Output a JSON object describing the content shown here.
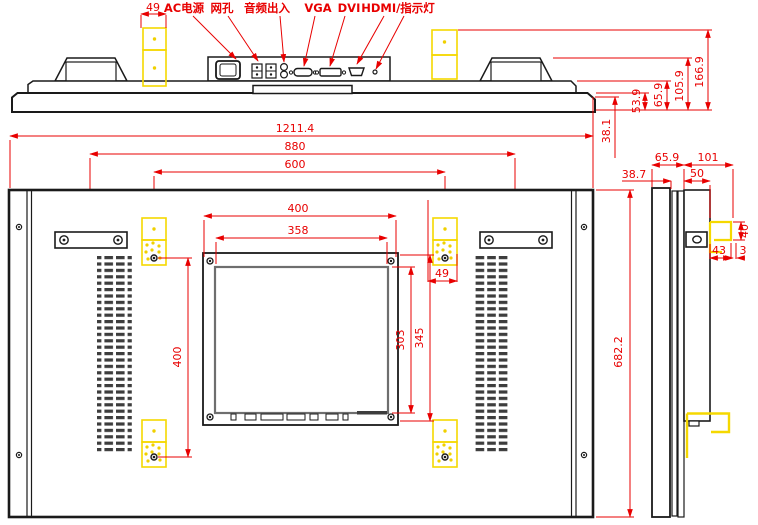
{
  "labels": {
    "ac_power": "AC电源",
    "mesh": "网孔",
    "audio": "音频出入",
    "vga": "VGA",
    "dvi": "DVI",
    "hdmi_led": "HDMI/指示灯"
  },
  "top_dims": {
    "bracket_w": "49",
    "depth_bezel": "53.9",
    "depth_mid": "65.9",
    "depth_body": "105.9",
    "depth_total": "166.9",
    "offset": "38.1"
  },
  "front_dims": {
    "overall_w": "1211.4",
    "handle_span": "880",
    "mount_span_h": "600",
    "module_w": "400",
    "display_w": "358",
    "display_h": "303",
    "module_h": "345",
    "mount_span_v": "400",
    "bracket_w": "49",
    "overall_h": "682.2"
  },
  "side_dims": {
    "front_depth": "65.9",
    "rear_depth": "101",
    "bezel_depth": "38.7",
    "body_depth": "50",
    "hook_h": "40",
    "hook_w": "43",
    "hook_gap": "3"
  }
}
